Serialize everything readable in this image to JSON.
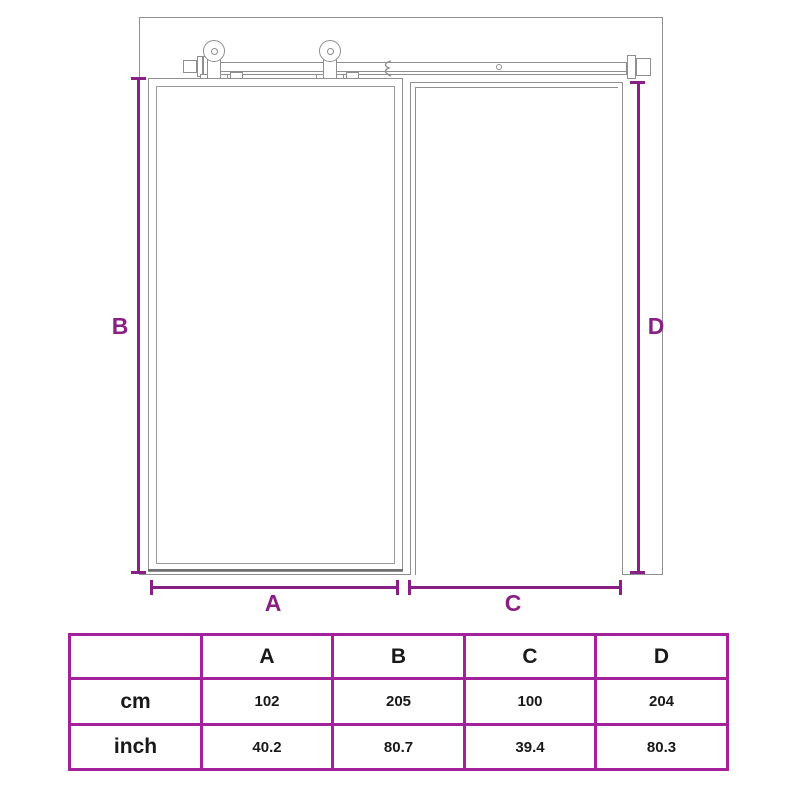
{
  "colors": {
    "dimension_purple": "#8a1f85",
    "table_border": "#a3219b",
    "drawing_gray": "#8f8f8f",
    "door_edge_dark": "#6f6f6f"
  },
  "diagram": {
    "labels": {
      "a": "A",
      "b": "B",
      "c": "C",
      "d": "D"
    }
  },
  "table": {
    "header": [
      "",
      "A",
      "B",
      "C",
      "D"
    ],
    "rows": [
      {
        "label": "cm",
        "values": [
          "102",
          "205",
          "100",
          "204"
        ]
      },
      {
        "label": "inch",
        "values": [
          "40.2",
          "80.7",
          "39.4",
          "80.3"
        ]
      }
    ]
  }
}
